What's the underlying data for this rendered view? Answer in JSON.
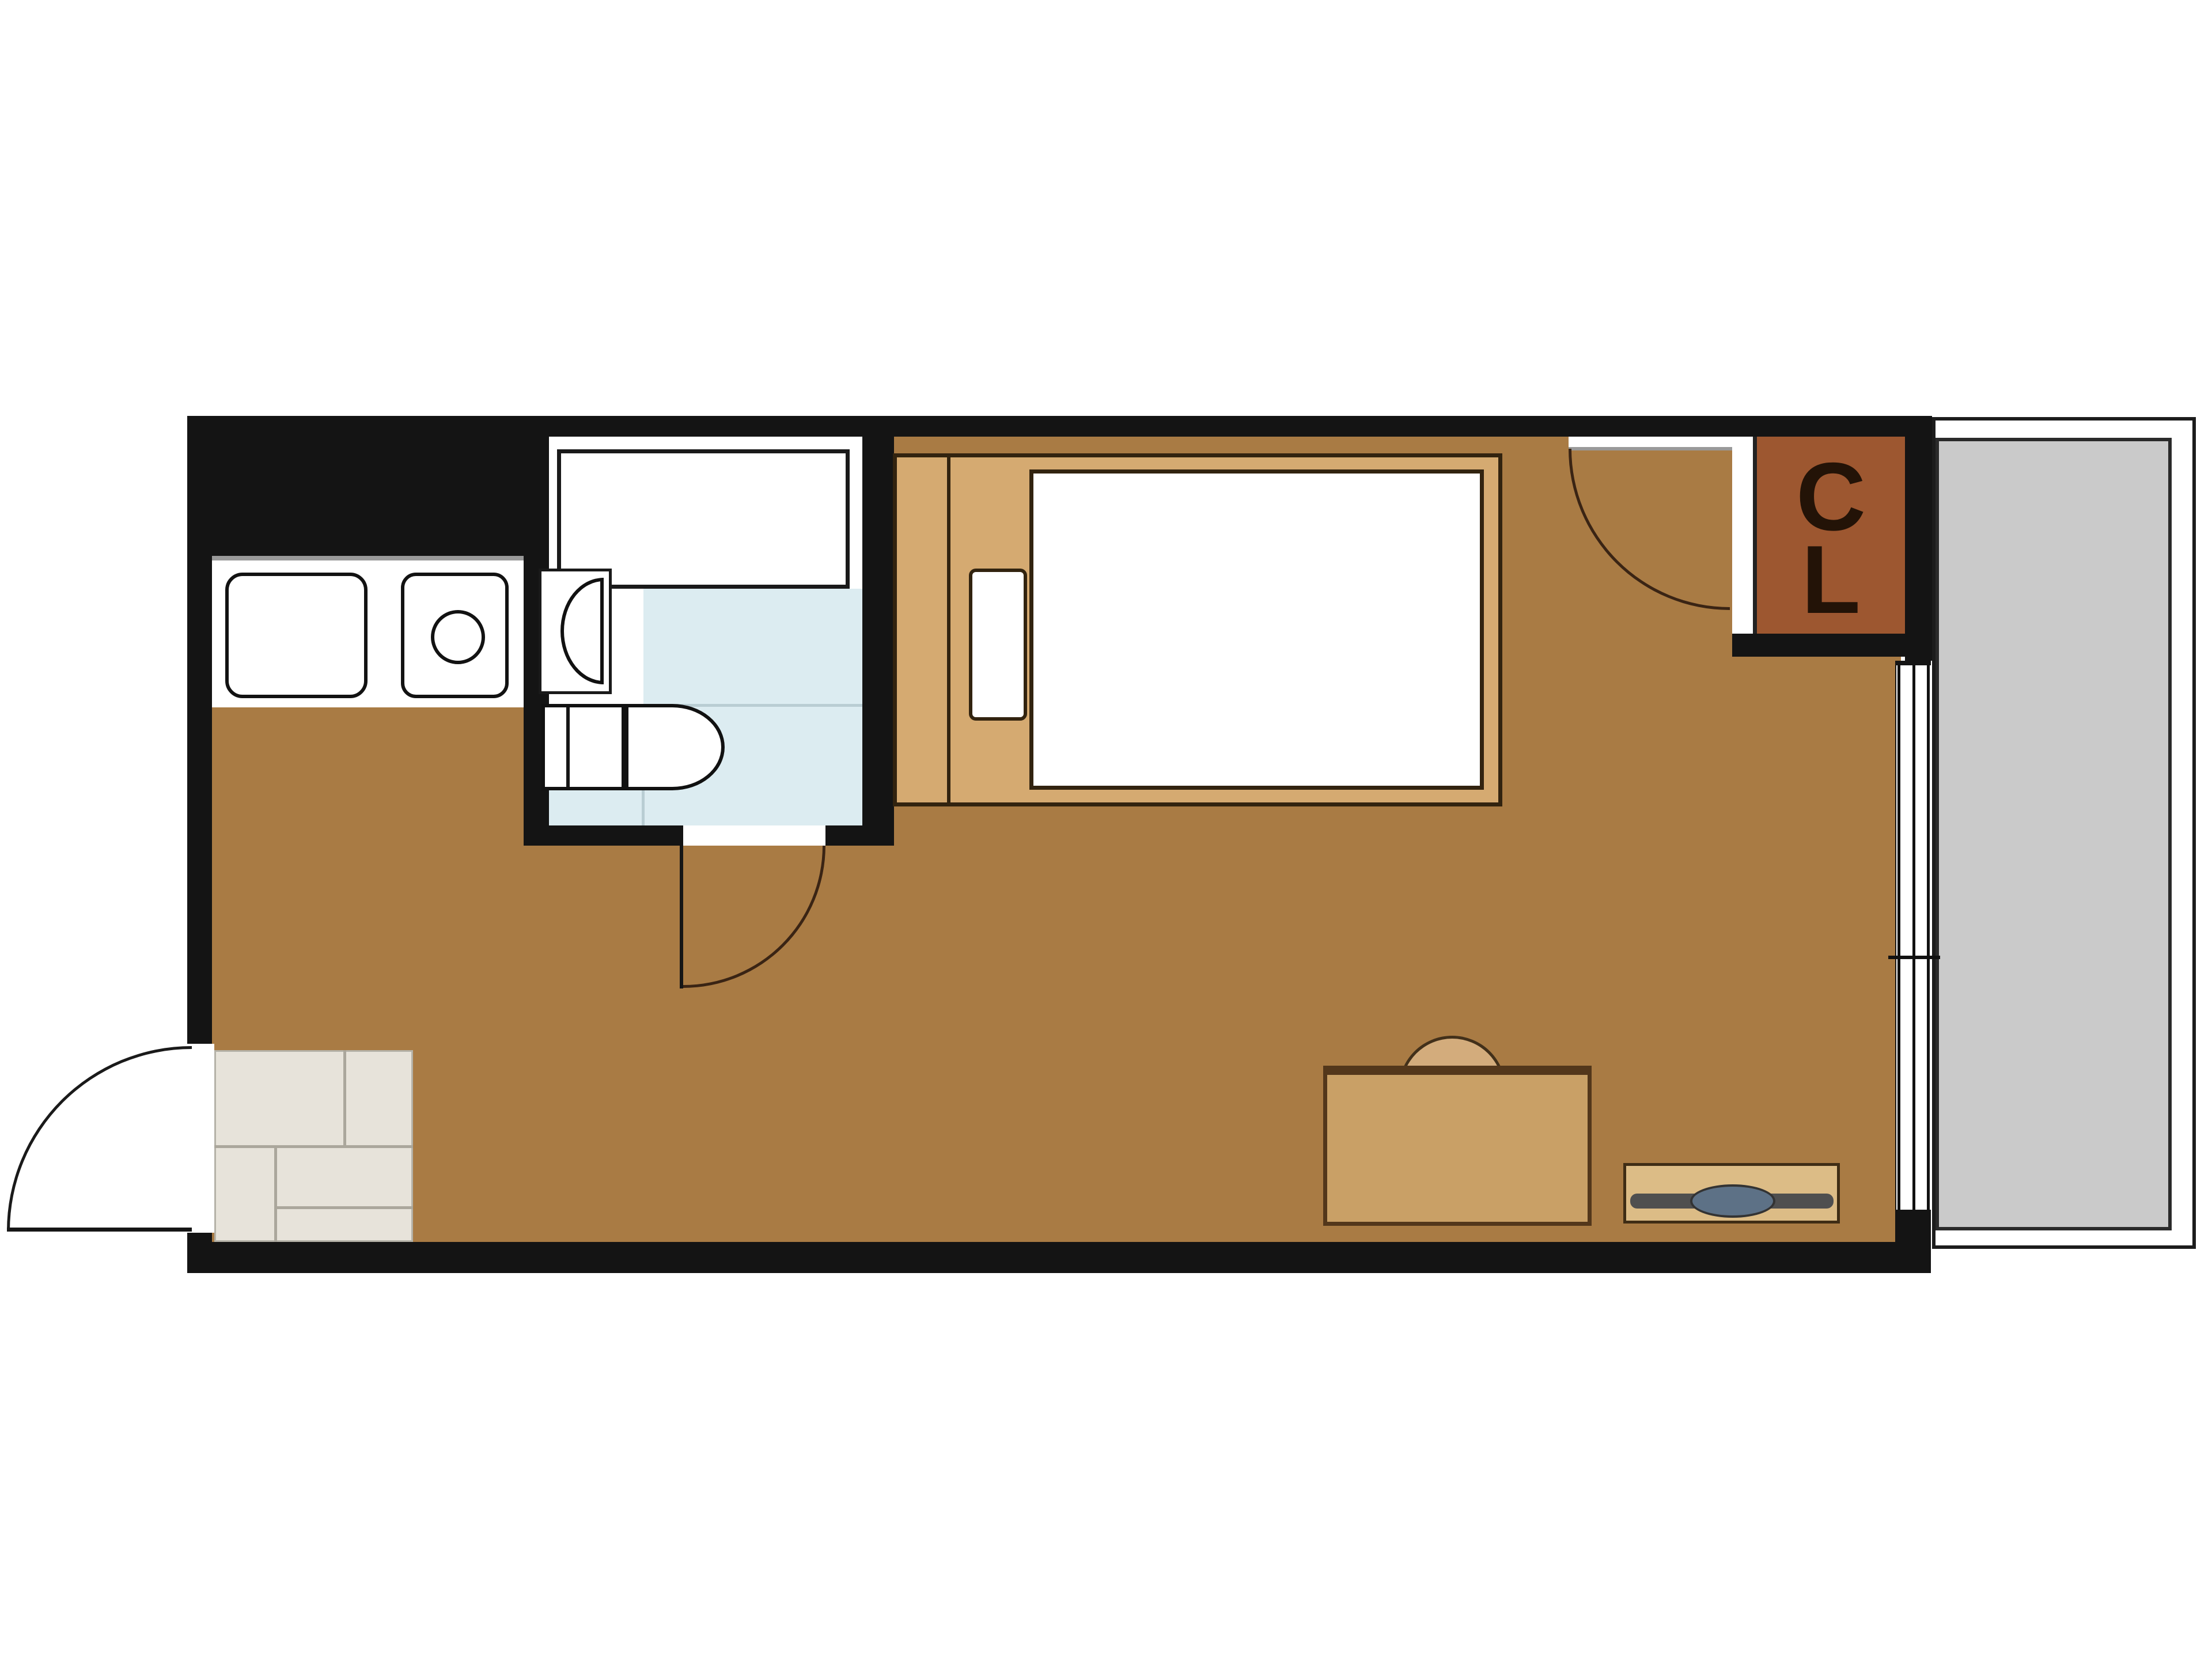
{
  "closet": {
    "line1": "C",
    "line2": "L"
  },
  "colors": {
    "wall": "#141414",
    "floor": "#a97b44",
    "room_outline": "#32230f",
    "bed_frame": "#d5aa71",
    "bath_floor": "#dcecf1",
    "bath_tile_line": "#b9cdd3",
    "genkan_tile": "#e7e3da",
    "genkan_line": "#aba79c",
    "balcony": "#cacaca",
    "balcony_line": "#1c1c1c",
    "closet": "#9d5730",
    "closet_text": "#231307",
    "desk": "#c9a066",
    "desk_edge": "#53371b",
    "chair": "#d3ac7c",
    "tv_board": "#dcbc86",
    "tv_bar": "#4f4f4f",
    "tv_screen": "#5d7186",
    "counter_edge": "#9a9a9a"
  }
}
